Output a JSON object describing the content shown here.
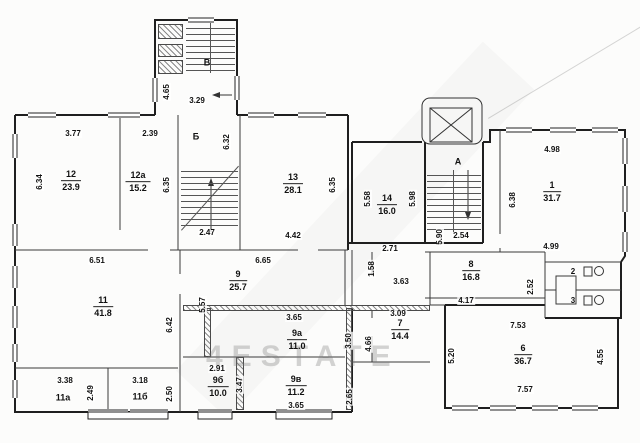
{
  "watermark": {
    "text": "4ESTATE"
  },
  "stairwells": {
    "top": "В",
    "mid": "Б",
    "right": "А"
  },
  "rooms": {
    "r12": {
      "num": "12",
      "area": "23.9"
    },
    "r12a": {
      "num": "12а",
      "area": "15.2"
    },
    "r13": {
      "num": "13",
      "area": "28.1"
    },
    "r14": {
      "num": "14",
      "area": "16.0"
    },
    "r1": {
      "num": "1",
      "area": "31.7"
    },
    "r11": {
      "num": "11",
      "area": "41.8"
    },
    "r9": {
      "num": "9",
      "area": "25.7"
    },
    "r8": {
      "num": "8",
      "area": "16.8"
    },
    "r7": {
      "num": "7",
      "area": "14.4"
    },
    "r9a": {
      "num": "9а",
      "area": "11.0"
    },
    "r9b": {
      "num": "9б",
      "area": "10.0"
    },
    "r9v": {
      "num": "9в",
      "area": "11.2"
    },
    "r6": {
      "num": "6",
      "area": "36.7"
    },
    "r11a": {
      "num": "11а"
    },
    "r11b": {
      "num": "11б"
    },
    "r2": {
      "num": "2"
    },
    "r3": {
      "num": "3"
    }
  },
  "dims": {
    "v465": "4.65",
    "h329": "3.29",
    "h377": "3.77",
    "h239": "2.39",
    "v634": "6.34",
    "v635a": "6.35",
    "v632": "6.32",
    "h247": "2.47",
    "h442": "4.42",
    "v635b": "6.35",
    "v558": "5.58",
    "v598": "5.98",
    "h271": "2.71",
    "h254": "2.54",
    "v590": "5.90",
    "h498": "4.98",
    "h499": "4.99",
    "v638": "6.38",
    "h651": "6.51",
    "h665": "6.65",
    "v642": "6.42",
    "v557": "5.57",
    "v158": "1.58",
    "h363": "3.63",
    "h309": "3.09",
    "h417": "4.17",
    "v252": "2.52",
    "h365a": "3.65",
    "v350": "3.50",
    "v466": "4.66",
    "h291": "2.91",
    "v347": "3.47",
    "h365b": "3.65",
    "v265": "2.65",
    "h338": "3.38",
    "v249": "2.49",
    "h318": "3.18",
    "v250": "2.50",
    "h753": "7.53",
    "h757": "7.57",
    "v520": "5.20",
    "v455": "4.55"
  }
}
